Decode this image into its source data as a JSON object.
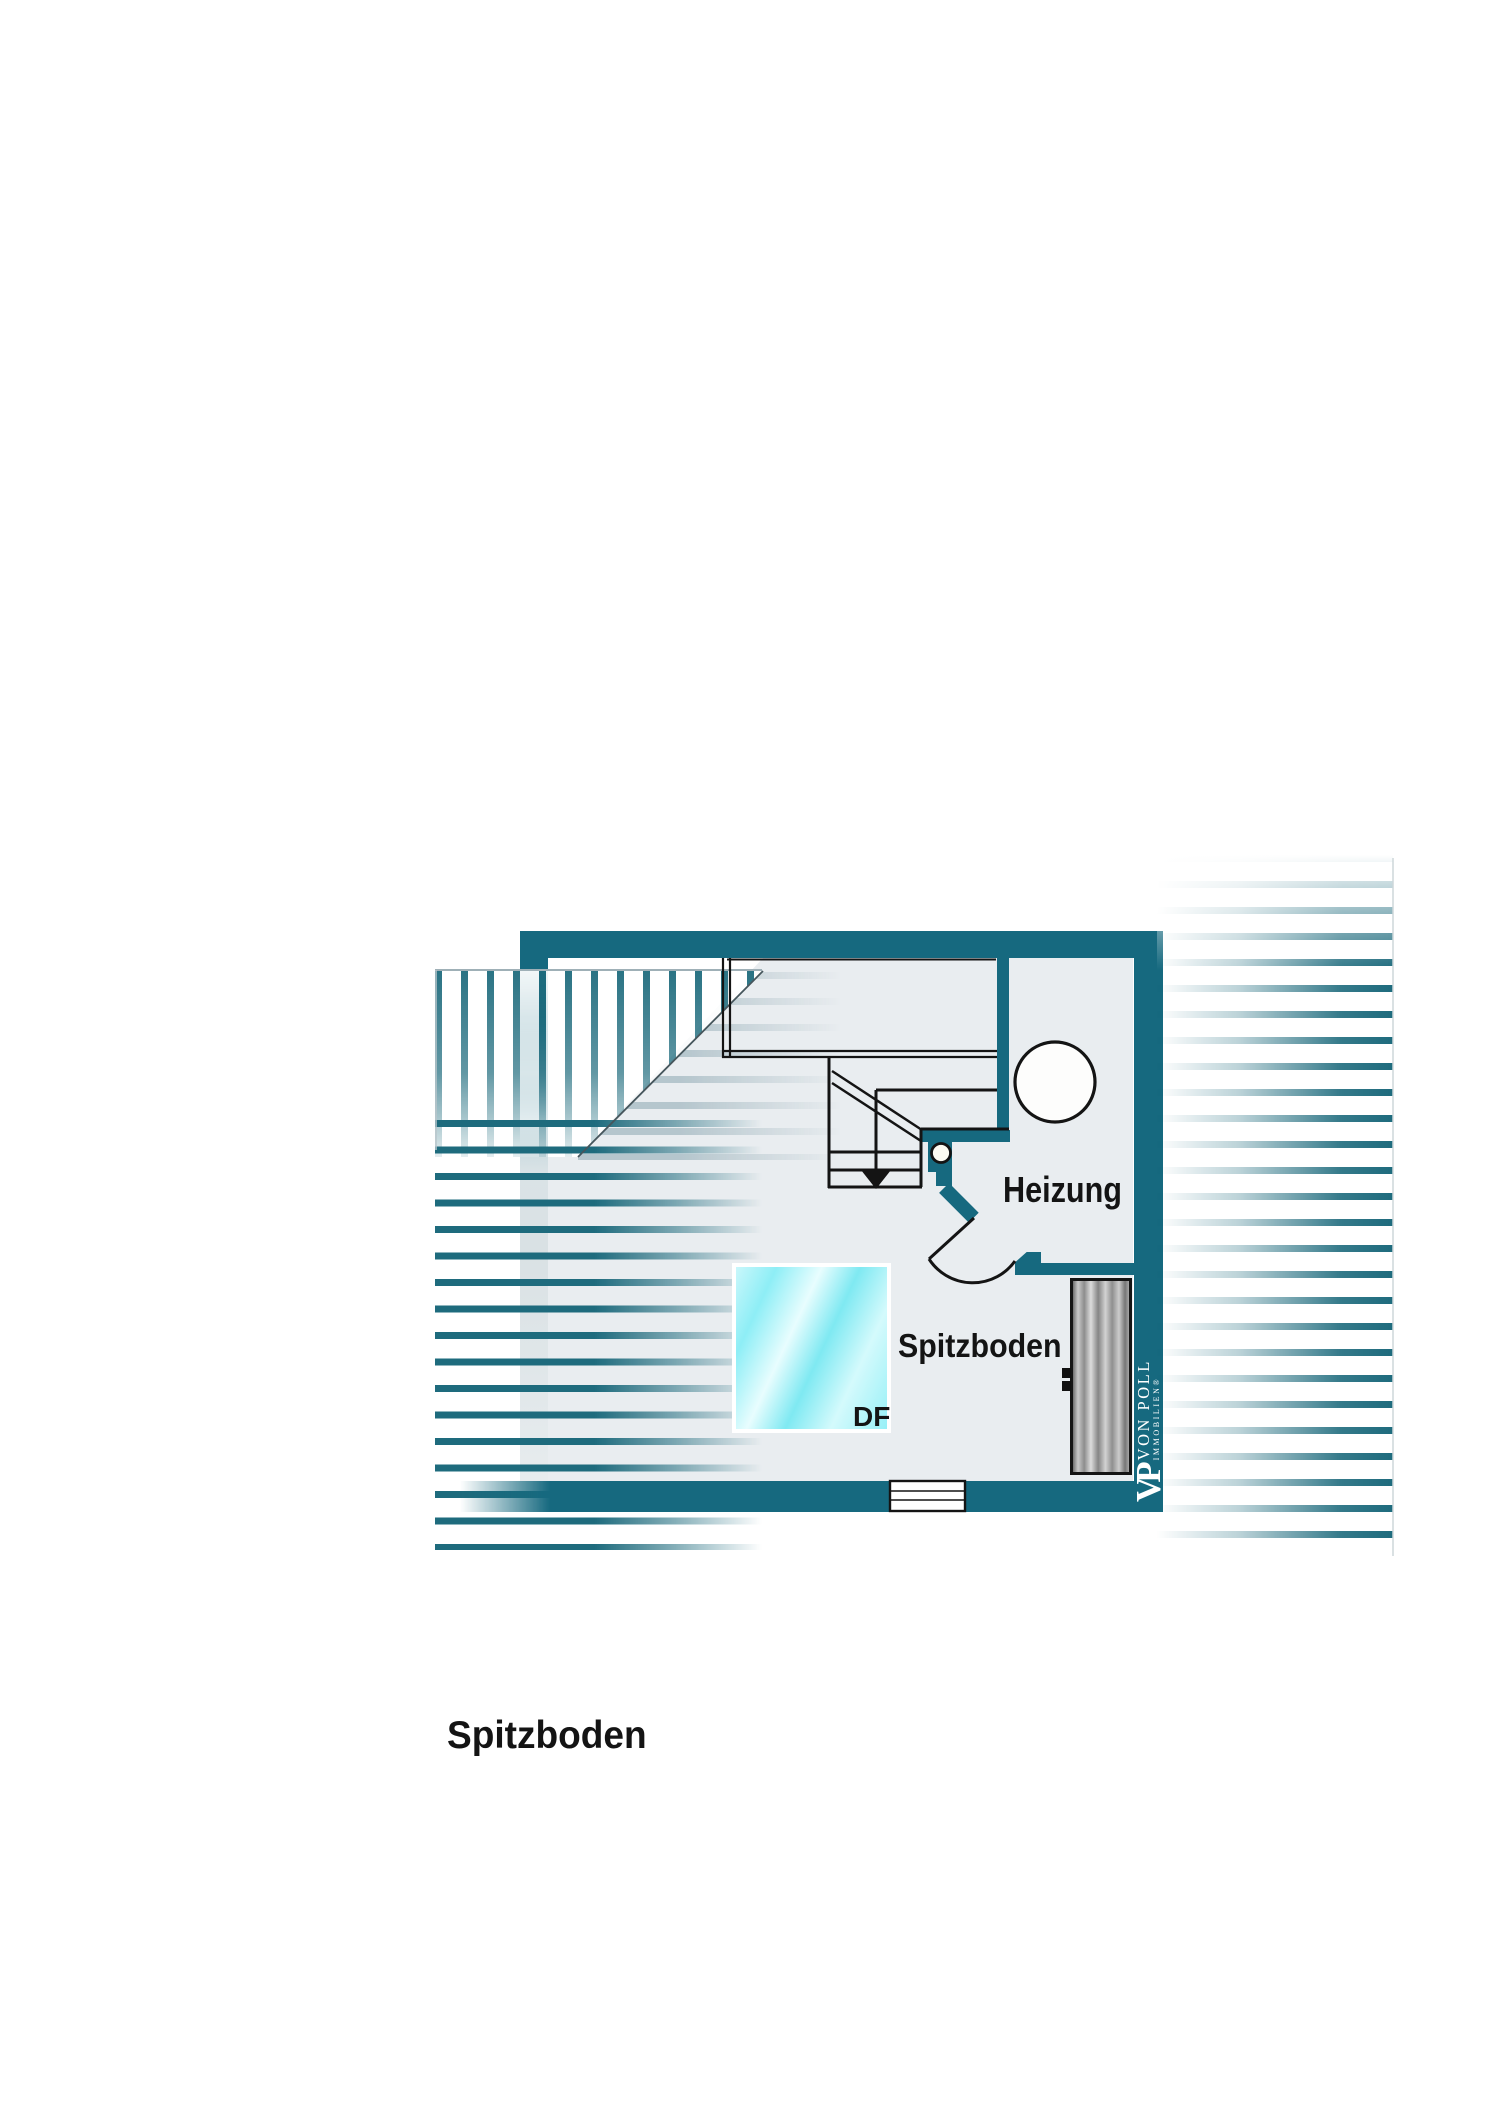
{
  "plan": {
    "title": "Spitzboden",
    "rooms": {
      "heizung": {
        "label": "Heizung"
      },
      "spitzboden": {
        "label": "Spitzboden"
      }
    },
    "skylight": {
      "label": "DF"
    }
  },
  "logo": {
    "monogram": "VP",
    "name": "VON POLL",
    "subtitle": "IMMOBILIEN®"
  },
  "colors": {
    "wall_teal": "#16697f",
    "stripe_teal": "#1e6b7d",
    "interior_grey": "#e9edf0",
    "line_black": "#141414",
    "skylight_cyan": "#7fe9f2",
    "wardrobe_grey": "#9a9a9a",
    "logo_white": "#ffffff"
  }
}
